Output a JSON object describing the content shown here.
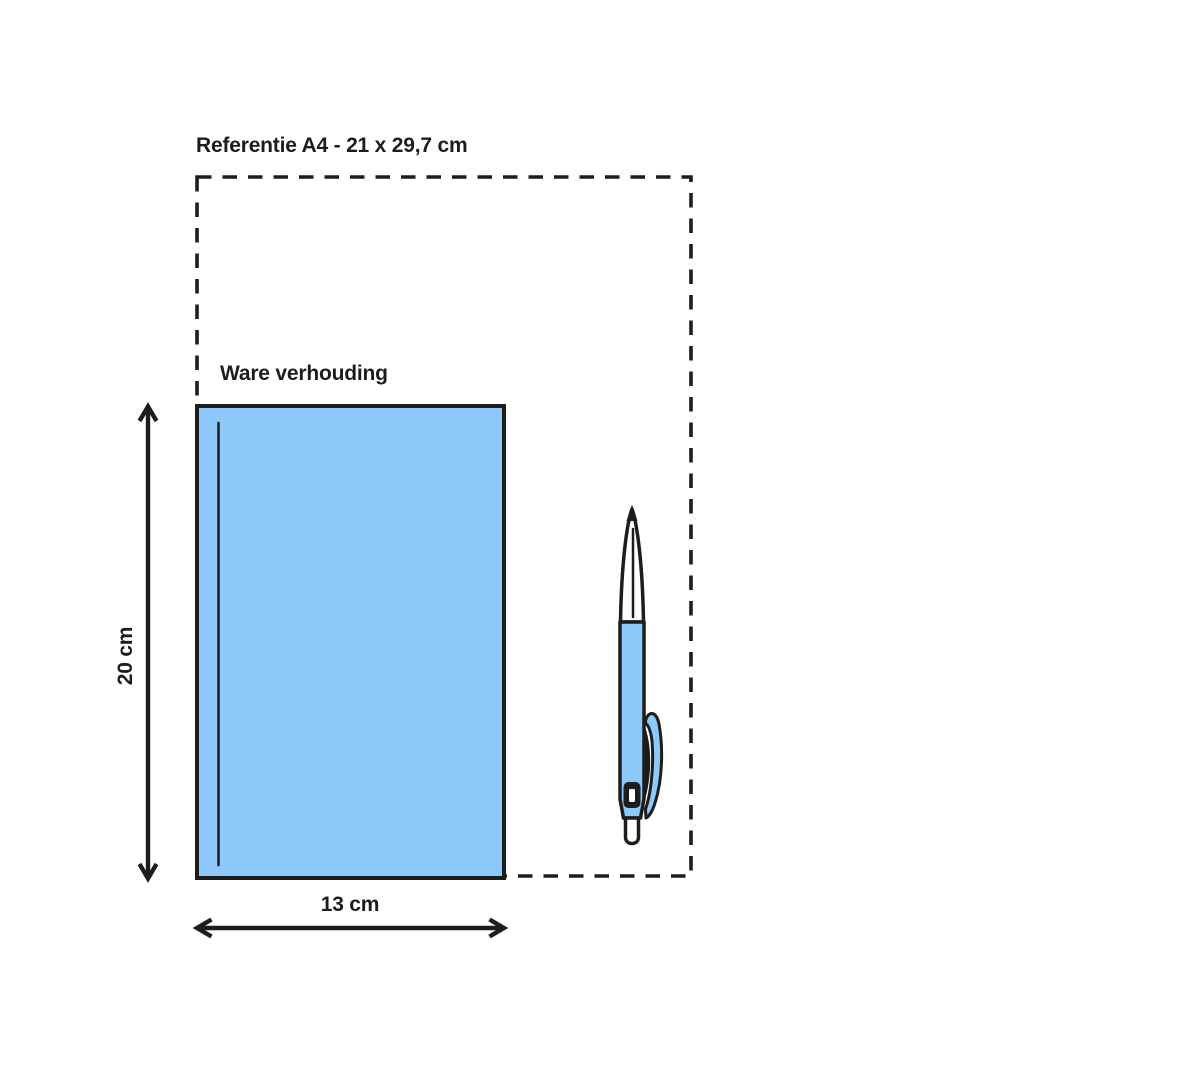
{
  "diagram": {
    "title": "Referentie A4 - 21 x 29,7 cm",
    "true_scale_label": "Ware verhouding",
    "height_label": "20 cm",
    "width_label": "13 cm",
    "colors": {
      "line": "#1d1d1b",
      "product_fill": "#8dc9fa",
      "highlight_fill": "#ffffff",
      "background": "#ffffff"
    },
    "illustration": "ballpoint-pen"
  }
}
